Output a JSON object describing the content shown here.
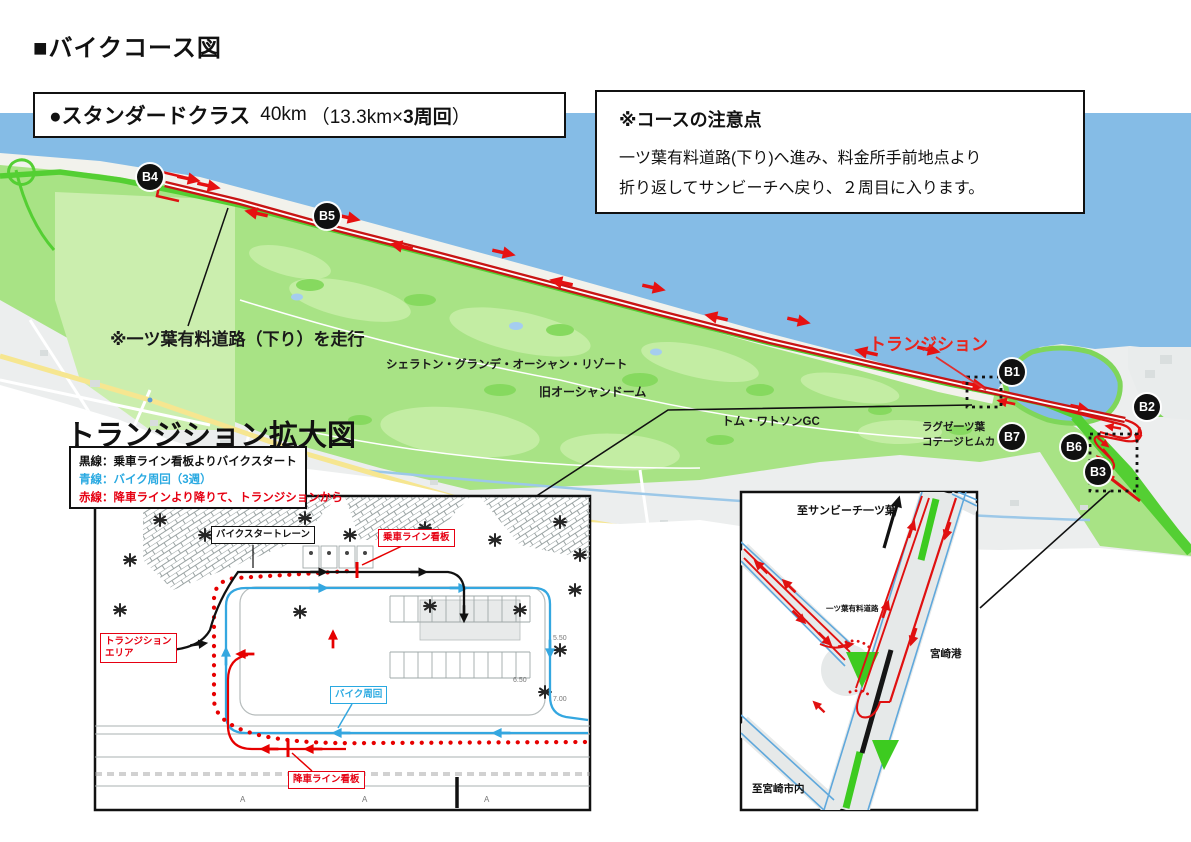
{
  "title": "■バイクコース図",
  "course_header": {
    "class_name": "●スタンダードクラス",
    "distance": "40km",
    "laps_prefix": "（13.3km×",
    "laps_bold": "3周回",
    "laps_suffix": "）"
  },
  "notes": {
    "heading": "※コースの注意点",
    "line1": "一ツ葉有料道路(下り)へ進み、料金所手前地点より",
    "line2": "折り返してサンビーチへ戻り、２周目に入ります。"
  },
  "map": {
    "toll_road_note": "※一ツ葉有料道路（下り）を走行",
    "transition_label": "トランジション",
    "place_sheraton": "シェラトン・グランデ・オーシャン・リゾート",
    "place_ocean_dome": "旧オーシャンドーム",
    "place_tom_watson": "トム・ワトソンGC",
    "place_luxze_line1": "ラグゼ一ツ葉",
    "place_luxze_line2": "コテージヒムカ",
    "markers": {
      "b1": "B1",
      "b2": "B2",
      "b3": "B3",
      "b4": "B4",
      "b5": "B5",
      "b6": "B6",
      "b7": "B7"
    }
  },
  "enlarged_map": {
    "heading": "トランジション拡大図",
    "legend_black": "黒線：乗車ライン看板よりバイクスタート",
    "legend_blue": "青線：バイク周回（3週）",
    "legend_red": "赤線：降車ラインより降りて、トランジションから",
    "label_bike_start_lane": "バイクスタートレーン",
    "label_mount_sign": "乗車ライン看板",
    "label_transition_area_1": "トランジション",
    "label_transition_area_2": "エリア",
    "label_bike_loop": "バイク周回",
    "label_dismount_sign": "降車ライン看板",
    "plan_num_1": "5.50",
    "plan_num_2": "6.50",
    "plan_num_3": "7.00",
    "plan_mark_a": "A"
  },
  "junction_map": {
    "label_to_sunbeach": "至サンビーチ一ツ葉",
    "label_toll_road": "一ツ葉有料道路",
    "label_port": "宮崎港",
    "label_to_city": "至宮崎市内"
  },
  "colors": {
    "water": "#85BCE6",
    "land_green": "#A8E385",
    "toll_green": "#52CE35",
    "course_red": "#C81414",
    "legend_blue": "#29A9E1",
    "legend_red": "#E60012"
  }
}
